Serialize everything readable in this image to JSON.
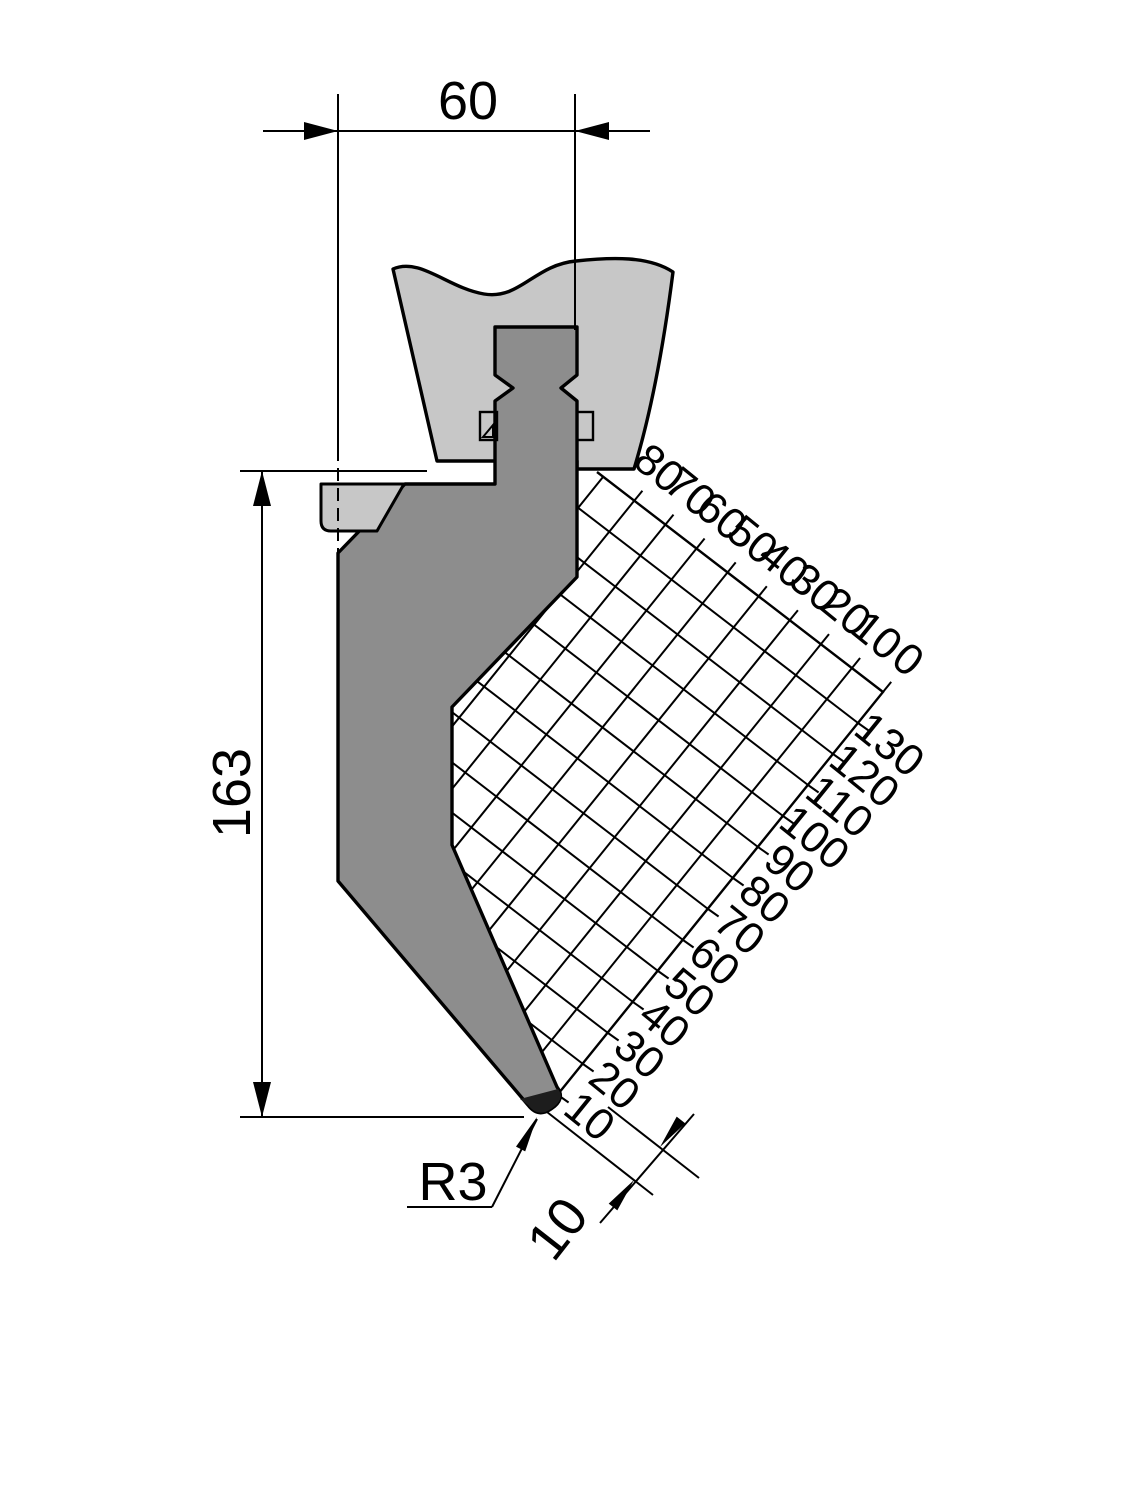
{
  "drawing": {
    "dim_width": "60",
    "dim_height": "163",
    "tip_radius": "R3",
    "tip_offset": "10",
    "rulers": {
      "top_labels": [
        "80",
        "70",
        "60",
        "50",
        "40",
        "30",
        "20",
        "10",
        "0"
      ],
      "right_labels": [
        "130",
        "120",
        "110",
        "100",
        "90",
        "80",
        "70",
        "60",
        "50",
        "40",
        "30",
        "20",
        "10"
      ]
    },
    "colors": {
      "clamp": "#c7c7c7",
      "punch": "#8d8d8d",
      "tip": "#1d1d1d",
      "line": "#000000",
      "background": "#ffffff"
    }
  }
}
